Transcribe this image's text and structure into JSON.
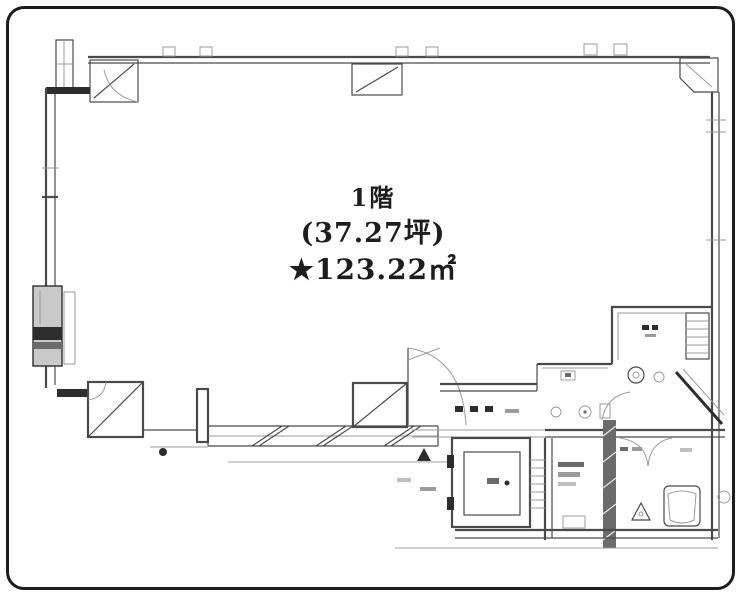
{
  "card": {
    "type": "floor-plan-drawing",
    "background": "#ffffff",
    "border_color": "#1c1c1c"
  },
  "plan": {
    "labels": {
      "floor": "1階",
      "area_tsubo": "(37.27坪)",
      "area_sqm": "★123.22㎡"
    },
    "colors": {
      "line": "#4a4a4a",
      "line_dark": "#2d2d2d",
      "line_light": "#9b9b9b",
      "shaft_fill": "#c9c9c9",
      "text": "#1d1d1d"
    },
    "features": [
      "open-floor-area",
      "pipe-shaft",
      "corner-columns",
      "window-band",
      "entry-door-swing",
      "elevator",
      "staircase",
      "kitchenette",
      "toilet-rooms",
      "sanitary-fixtures"
    ]
  }
}
